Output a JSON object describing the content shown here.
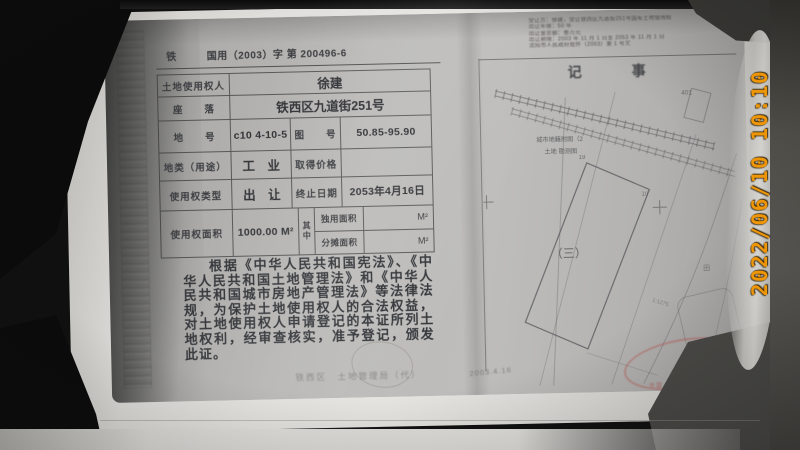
{
  "photo": {
    "timestamp": "2022/06/10 10:10"
  },
  "certificate": {
    "serial_prefix": "铁",
    "serial_number": "国用（2003）字 第 200496-6",
    "table": {
      "holder_label": "土地使用权人",
      "holder_value": "徐建",
      "location_label": "座　　落",
      "location_value": "铁西区九道街251号",
      "parcel_label": "地　　号",
      "parcel_value": "c10 4-10-5",
      "sheet_label": "图　　号",
      "sheet_value": "50.85-95.90",
      "landuse_label": "地类（用途）",
      "landuse_value": "工　业",
      "price_label": "取得价格",
      "price_value": "",
      "tenure_label": "使用权类型",
      "tenure_value": "出　让",
      "expiry_label": "终止日期",
      "expiry_value": "2053年4月16日",
      "area_label": "使用权面积",
      "area_value": "1000.00 M²",
      "among_label": "其中",
      "exclusive_label": "独用面积",
      "exclusive_unit": "M²",
      "apportioned_label": "分摊面积",
      "apportioned_unit": "M²"
    },
    "declaration": "根据《中华人民共和国宪法》、《中华人民共和国土地管理法》和《中华人民共和国城市房地产管理法》等法律法规，为保护土地使用权人的合法权益，对土地使用权人申请登记的本证所列土地权利，经审查核实，准予登记，颁发此证。",
    "footer_issuer": "铁西区　土地管理局（代）"
  },
  "notes_page": {
    "title": "记　事",
    "annotations": [
      "受让方：徐建，受让铁西区九道街251号国有土地使用权",
      "出让年限：50 年",
      "出让金总额：叁万元",
      "出让期限：2003 年 11 月 1 日至 2053 年 11 月 1 日",
      "沈阳市人民政府批件（2003）第 1 号文"
    ],
    "map": {
      "caption_line1": "城市地籍附图（2",
      "caption_line2": "土地 勘测图",
      "parcel_mark": "（三）",
      "plot_401": "401",
      "point_19": "19",
      "point_10": "10",
      "field_mark": "田",
      "scale_mark": "1:1275"
    },
    "seal_text": "市国土资源和房屋管理局",
    "seal_star": "★",
    "written_date": "2003.4.16"
  },
  "colors": {
    "timestamp_orange": "#ee9608",
    "seal_red": "#b5453f"
  }
}
